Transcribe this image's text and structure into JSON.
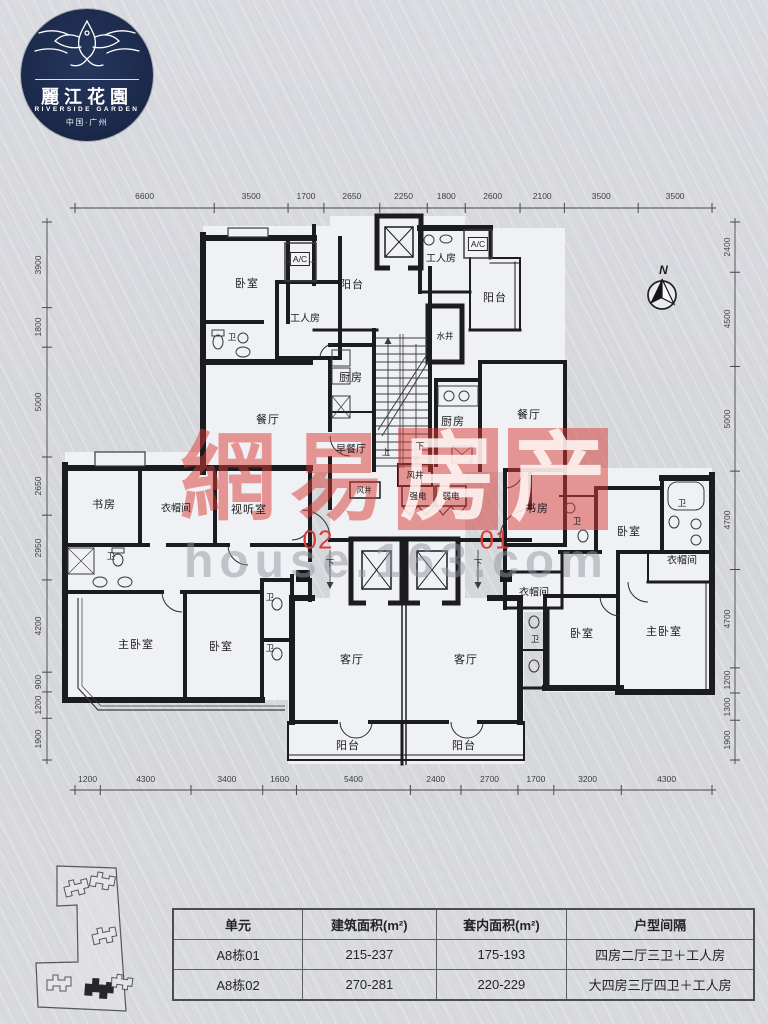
{
  "logo": {
    "cn": "麗江花園",
    "en": "RIVERSIDE GARDEN",
    "sub": "中国·广州"
  },
  "compass": {
    "label": "N"
  },
  "watermark": {
    "cn": [
      "網",
      "易",
      "房",
      "产"
    ],
    "url": "house.163.com",
    "red": "#d83932",
    "gray": "#94969f"
  },
  "plan": {
    "unit_labels": [
      {
        "t": "02",
        "x": 318,
        "y": 540
      },
      {
        "t": "01",
        "x": 495,
        "y": 540
      }
    ],
    "rooms": [
      {
        "t": "卧室",
        "x": 247,
        "y": 283
      },
      {
        "t": "A/C",
        "x": 300,
        "y": 259,
        "c": "box"
      },
      {
        "t": "工人房",
        "x": 305,
        "y": 317,
        "c": "m"
      },
      {
        "t": "阳台",
        "x": 352,
        "y": 284
      },
      {
        "t": "工人房",
        "x": 441,
        "y": 257,
        "c": "m"
      },
      {
        "t": "A/C",
        "x": 478,
        "y": 244,
        "c": "box"
      },
      {
        "t": "阳台",
        "x": 495,
        "y": 297
      },
      {
        "t": "水井",
        "x": 445,
        "y": 336,
        "c": "s"
      },
      {
        "t": "厨房",
        "x": 351,
        "y": 377
      },
      {
        "t": "餐厅",
        "x": 268,
        "y": 419
      },
      {
        "t": "早餐厅",
        "x": 351,
        "y": 448,
        "c": "m"
      },
      {
        "t": "厨房",
        "x": 453,
        "y": 421
      },
      {
        "t": "餐厅",
        "x": 529,
        "y": 414
      },
      {
        "t": "书房",
        "x": 104,
        "y": 504
      },
      {
        "t": "衣帽间",
        "x": 176,
        "y": 507,
        "c": "m"
      },
      {
        "t": "视听室",
        "x": 249,
        "y": 509
      },
      {
        "t": "书房",
        "x": 537,
        "y": 508
      },
      {
        "t": "卧室",
        "x": 629,
        "y": 531
      },
      {
        "t": "衣帽间",
        "x": 682,
        "y": 559,
        "c": "m"
      },
      {
        "t": "主卧室",
        "x": 136,
        "y": 644
      },
      {
        "t": "卧室",
        "x": 221,
        "y": 646
      },
      {
        "t": "客厅",
        "x": 352,
        "y": 659
      },
      {
        "t": "客厅",
        "x": 466,
        "y": 659
      },
      {
        "t": "衣帽间",
        "x": 534,
        "y": 591,
        "c": "m"
      },
      {
        "t": "卧室",
        "x": 582,
        "y": 633
      },
      {
        "t": "主卧室",
        "x": 664,
        "y": 631
      },
      {
        "t": "阳台",
        "x": 348,
        "y": 745
      },
      {
        "t": "阳台",
        "x": 464,
        "y": 745
      },
      {
        "t": "卫",
        "x": 232,
        "y": 337,
        "c": "s"
      },
      {
        "t": "卫",
        "x": 111,
        "y": 556,
        "c": "s"
      },
      {
        "t": "卫",
        "x": 270,
        "y": 597,
        "c": "s"
      },
      {
        "t": "卫",
        "x": 270,
        "y": 648,
        "c": "s"
      },
      {
        "t": "卫",
        "x": 577,
        "y": 521,
        "c": "s"
      },
      {
        "t": "卫",
        "x": 682,
        "y": 503,
        "c": "s"
      },
      {
        "t": "卫",
        "x": 535,
        "y": 639,
        "c": "s"
      },
      {
        "t": "风井",
        "x": 415,
        "y": 475,
        "c": "s"
      },
      {
        "t": "风井",
        "x": 364,
        "y": 490,
        "c": "xs"
      },
      {
        "t": "强电",
        "x": 418,
        "y": 496,
        "c": "s"
      },
      {
        "t": "弱电",
        "x": 451,
        "y": 496,
        "c": "s"
      },
      {
        "t": "上",
        "x": 386,
        "y": 452,
        "c": "s"
      },
      {
        "t": "下",
        "x": 420,
        "y": 446,
        "c": "s"
      },
      {
        "t": "下",
        "x": 330,
        "y": 563,
        "c": "s"
      },
      {
        "t": "下",
        "x": 478,
        "y": 563,
        "c": "s"
      }
    ]
  },
  "dims": {
    "top": [
      "6600",
      "3500",
      "1700",
      "2650",
      "2250",
      "1800",
      "2600",
      "2100",
      "3500",
      "3500"
    ],
    "bottom": [
      "1200",
      "4300",
      "3400",
      "1600",
      "5400",
      "2400",
      "2700",
      "1700",
      "3200",
      "4300"
    ],
    "left": [
      "3900",
      "1800",
      "5000",
      "2650",
      "2950",
      "4200",
      "900",
      "1200",
      "1900"
    ],
    "right": [
      "2400",
      "4500",
      "5000",
      "4700",
      "4700",
      "1200",
      "1300",
      "1900"
    ]
  },
  "table": {
    "headers": [
      "单元",
      "建筑面积(m²)",
      "套内面积(m²)",
      "户型间隔"
    ],
    "rows": [
      [
        "A8栋01",
        "215-237",
        "175-193",
        "四房二厅三卫＋工人房"
      ],
      [
        "A8栋02",
        "270-281",
        "220-229",
        "大四房三厅四卫＋工人房"
      ]
    ]
  }
}
